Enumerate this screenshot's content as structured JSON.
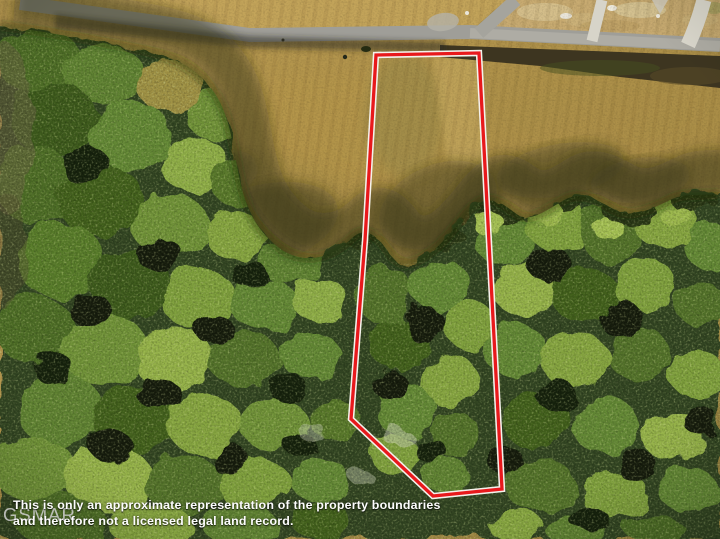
{
  "image": {
    "description": "Aerial drone photo of a wooded lot with field frontage on a rural road; property outlined in red"
  },
  "boundary": {
    "points": "376,55 479,53 502,489 433,496 351,419 365,240",
    "color": "#e8191c",
    "outline_color": "#f4f2ec"
  },
  "disclaimer": {
    "line1": "This is only an approximate representation of the property boundaries",
    "line2": "and therefore not a licensed legal land record."
  },
  "watermark": {
    "text": "GSMAR"
  }
}
